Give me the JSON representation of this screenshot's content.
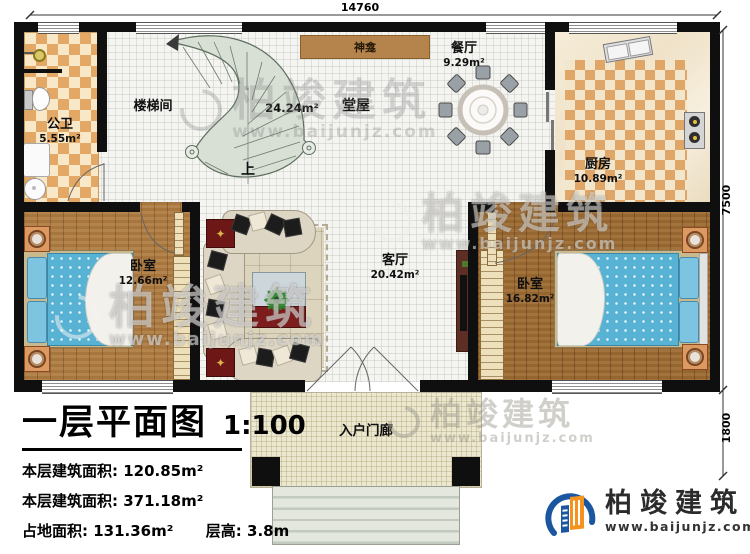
{
  "dimensions": {
    "top": "14760",
    "right_upper": "7500",
    "right_lower": "1800"
  },
  "rooms": {
    "bathroom": {
      "name": "公卫",
      "area": "5.55m²"
    },
    "stairwell": {
      "name": "楼梯间"
    },
    "hall": {
      "name": "堂屋",
      "area": "24.24m²"
    },
    "shrine": {
      "name": "神龛"
    },
    "stairs_up": {
      "label": "上"
    },
    "dining": {
      "name": "餐厅",
      "area": "9.29m²"
    },
    "kitchen": {
      "name": "厨房",
      "area": "10.89m²"
    },
    "bedroom_left": {
      "name": "卧室",
      "area": "12.66m²"
    },
    "living": {
      "name": "客厅",
      "area": "20.42m²"
    },
    "bedroom_right": {
      "name": "卧室",
      "area": "16.82m²"
    },
    "porch": {
      "name": "入户门廊"
    }
  },
  "title_block": {
    "title": "一层平面图",
    "scale": "1:100",
    "stats": [
      {
        "label": "本层建筑面积:",
        "value": "120.85m²"
      },
      {
        "label": "本层建筑面积:",
        "value": "371.18m²"
      },
      {
        "label": "占地面积:",
        "value": "131.36m²"
      },
      {
        "label": "层高:",
        "value": "3.8m"
      }
    ]
  },
  "brand": {
    "name": "柏竣建筑",
    "website": "www.baijunjz.com"
  },
  "watermark": {
    "name": "柏竣建筑",
    "website": "www.baijunjz.com"
  },
  "colors": {
    "wall": "#0f0f0f",
    "wood_light": "#b07c42",
    "wood_dark": "#9e6c33",
    "checker_orange": "#e3a865",
    "stair_fill": "#d8e0d6",
    "bed_blue": "#58b2d4",
    "brand_blue": "#1b57a0",
    "brand_orange": "#f6921e",
    "accent_red": "#7e1d1d"
  }
}
